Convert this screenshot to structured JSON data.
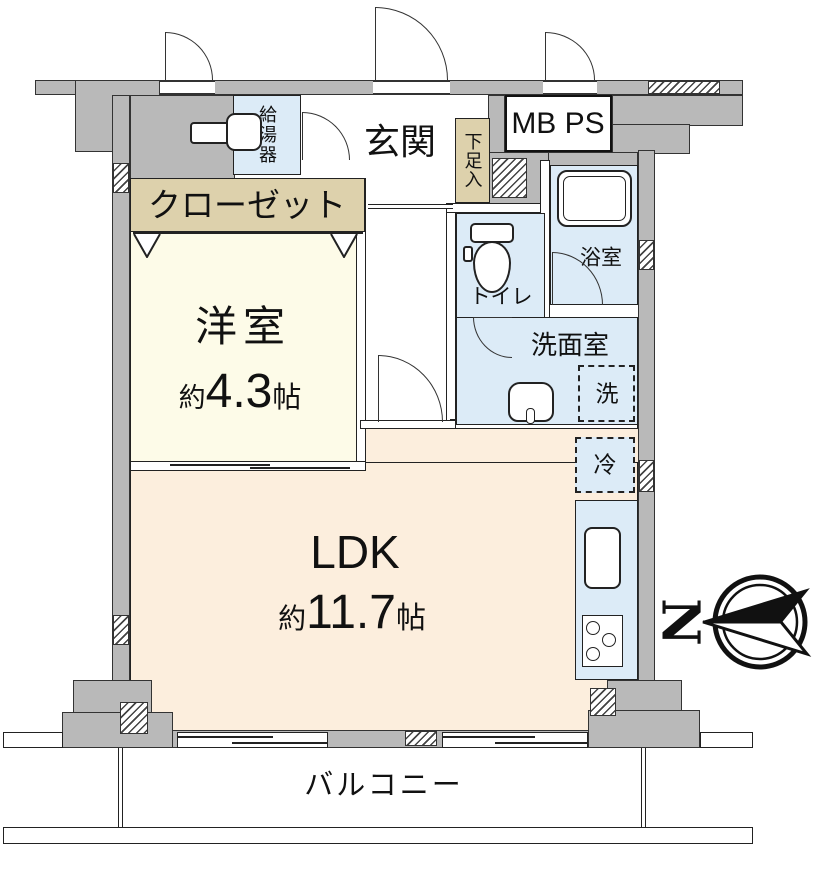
{
  "rooms": {
    "entrance": "玄関",
    "water_heater": "給湯器",
    "meter_pipe_space": "MB PS",
    "shoe_cabinet": "下足入",
    "closet": "クローゼット",
    "toilet": "トイレ",
    "bathroom": "浴室",
    "washroom": "洗面室",
    "washer_mark": "洗",
    "fridge_mark": "冷",
    "balcony": "バルコニー"
  },
  "western_room": {
    "name": "洋室",
    "approx": "約",
    "size": "4.3",
    "unit": "帖"
  },
  "ldk": {
    "name": "LDK",
    "approx": "約",
    "size": "11.7",
    "unit": "帖"
  },
  "compass": {
    "letter": "N"
  },
  "colors": {
    "wall_gray": "#b9b9b9",
    "western_room_fill": "#fdfbe8",
    "ldk_fill": "#fceedd",
    "wet_area_fill": "#dcebf7",
    "storage_fill": "#ddd1ac",
    "line": "#222222"
  }
}
